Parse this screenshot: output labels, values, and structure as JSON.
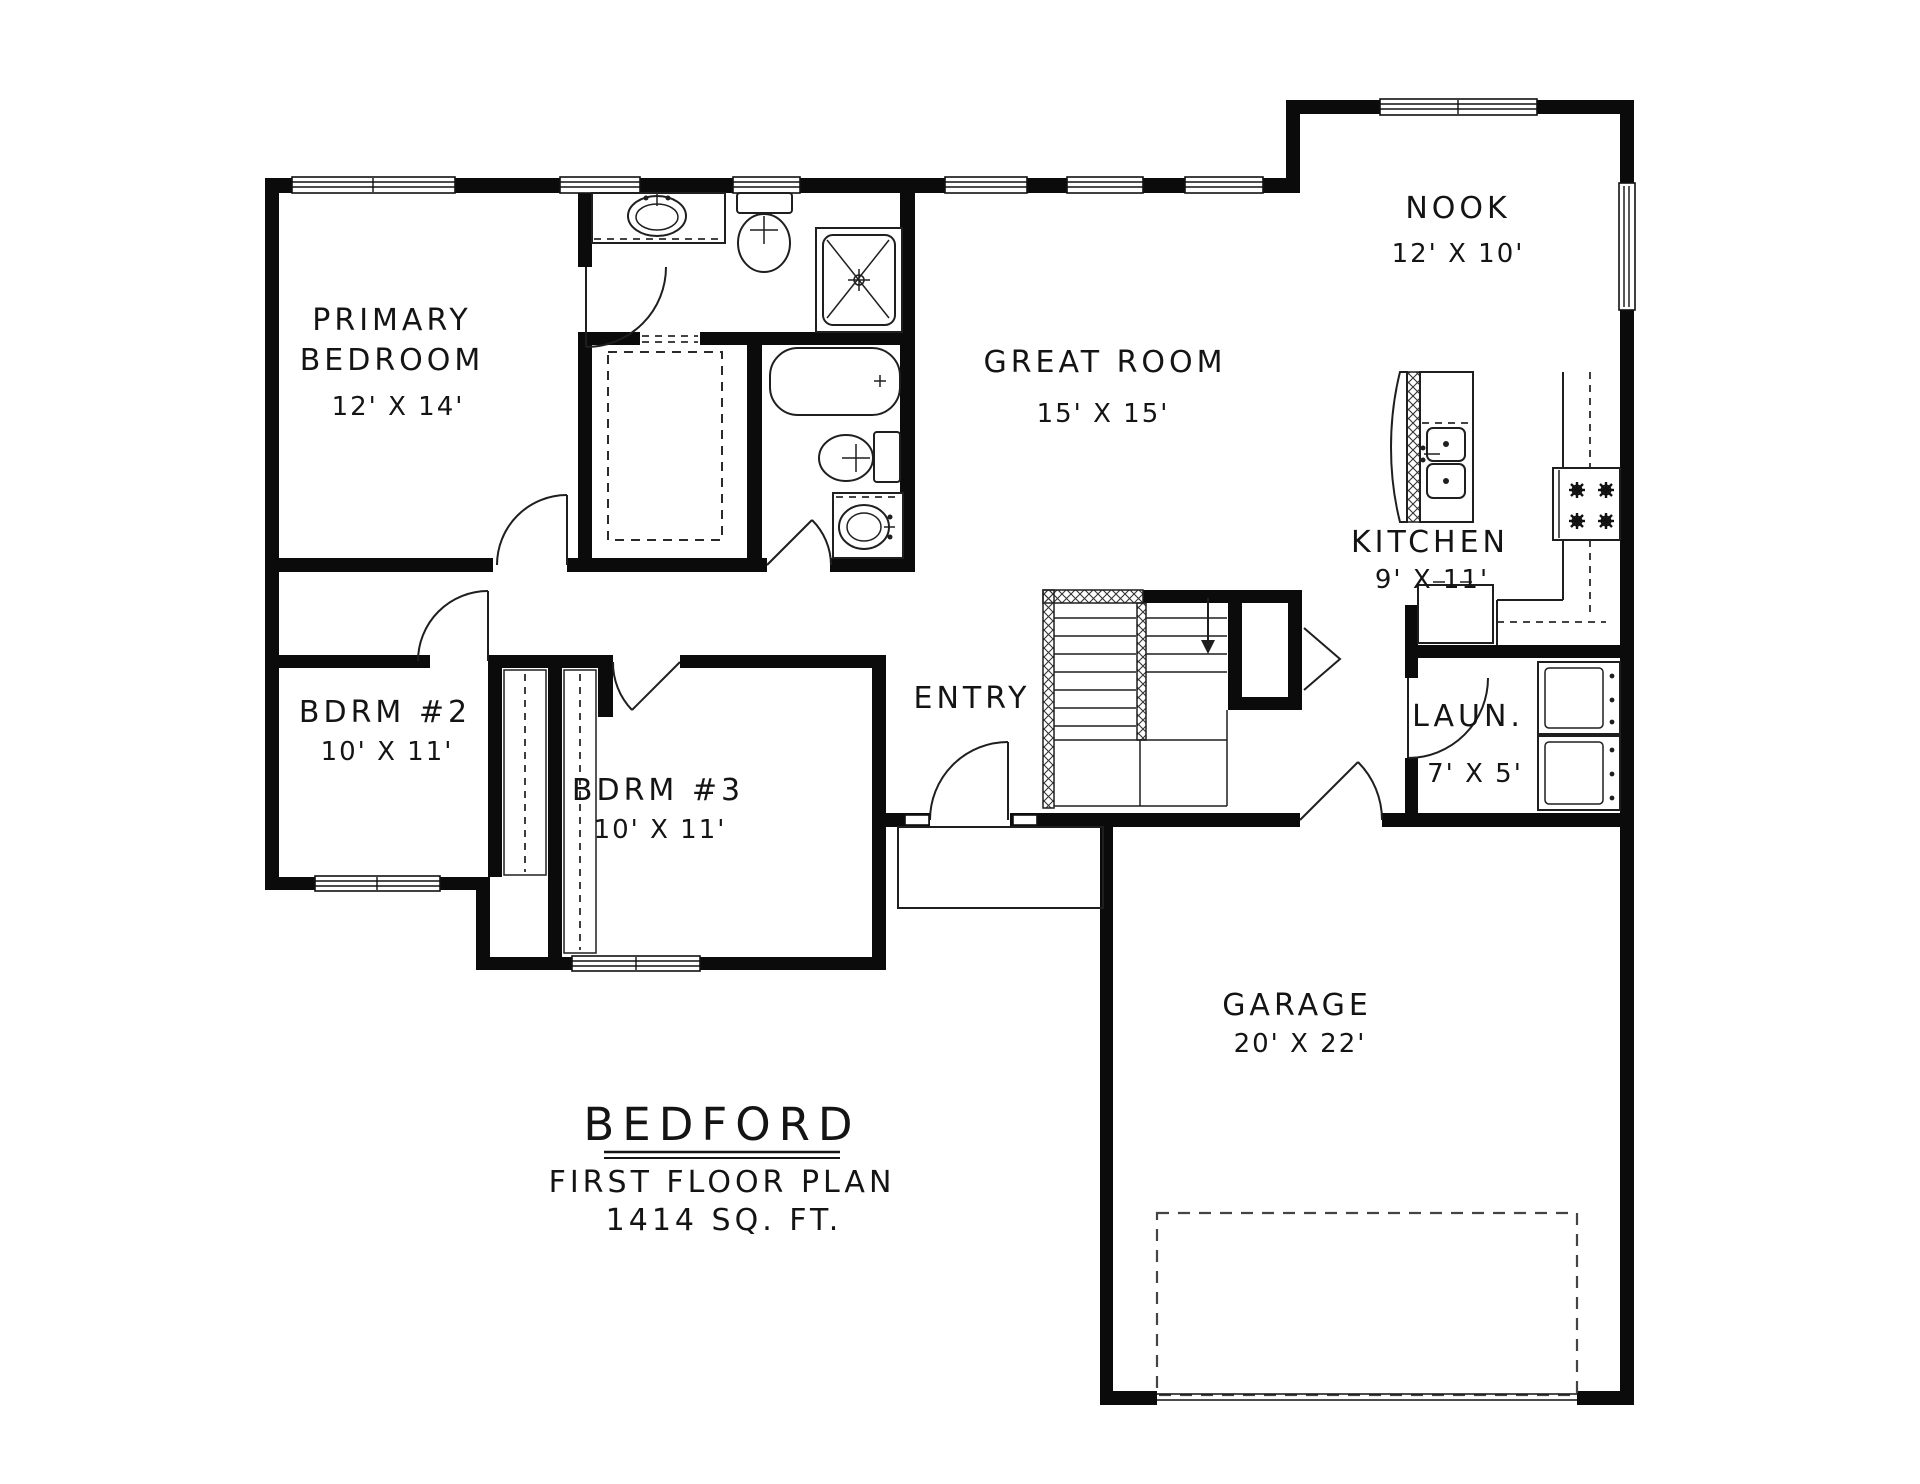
{
  "title_block": {
    "name": "BEDFORD",
    "subtitle": "FIRST FLOOR PLAN",
    "area": "1414 SQ. FT."
  },
  "rooms": {
    "primary_bedroom": {
      "line1": "PRIMARY",
      "line2": "BEDROOM",
      "dims": "12' X 14'"
    },
    "bdrm2": {
      "line1": "BDRM #2",
      "dims": "10' X 11'"
    },
    "bdrm3": {
      "line1": "BDRM #3",
      "dims": "10' X 11'"
    },
    "great_room": {
      "line1": "GREAT ROOM",
      "dims": "15' X 15'"
    },
    "nook": {
      "line1": "NOOK",
      "dims": "12' X 10'"
    },
    "kitchen": {
      "line1": "KITCHEN",
      "dims": "9' X 11'"
    },
    "laundry": {
      "line1": "LAUN.",
      "dims": "7' X 5'"
    },
    "entry": {
      "line1": "ENTRY"
    },
    "garage": {
      "line1": "GARAGE",
      "dims": "20' X 22'"
    }
  },
  "colors": {
    "walls": "#0b0b0b",
    "lines": "#1f1f1f",
    "background": "#ffffff"
  }
}
